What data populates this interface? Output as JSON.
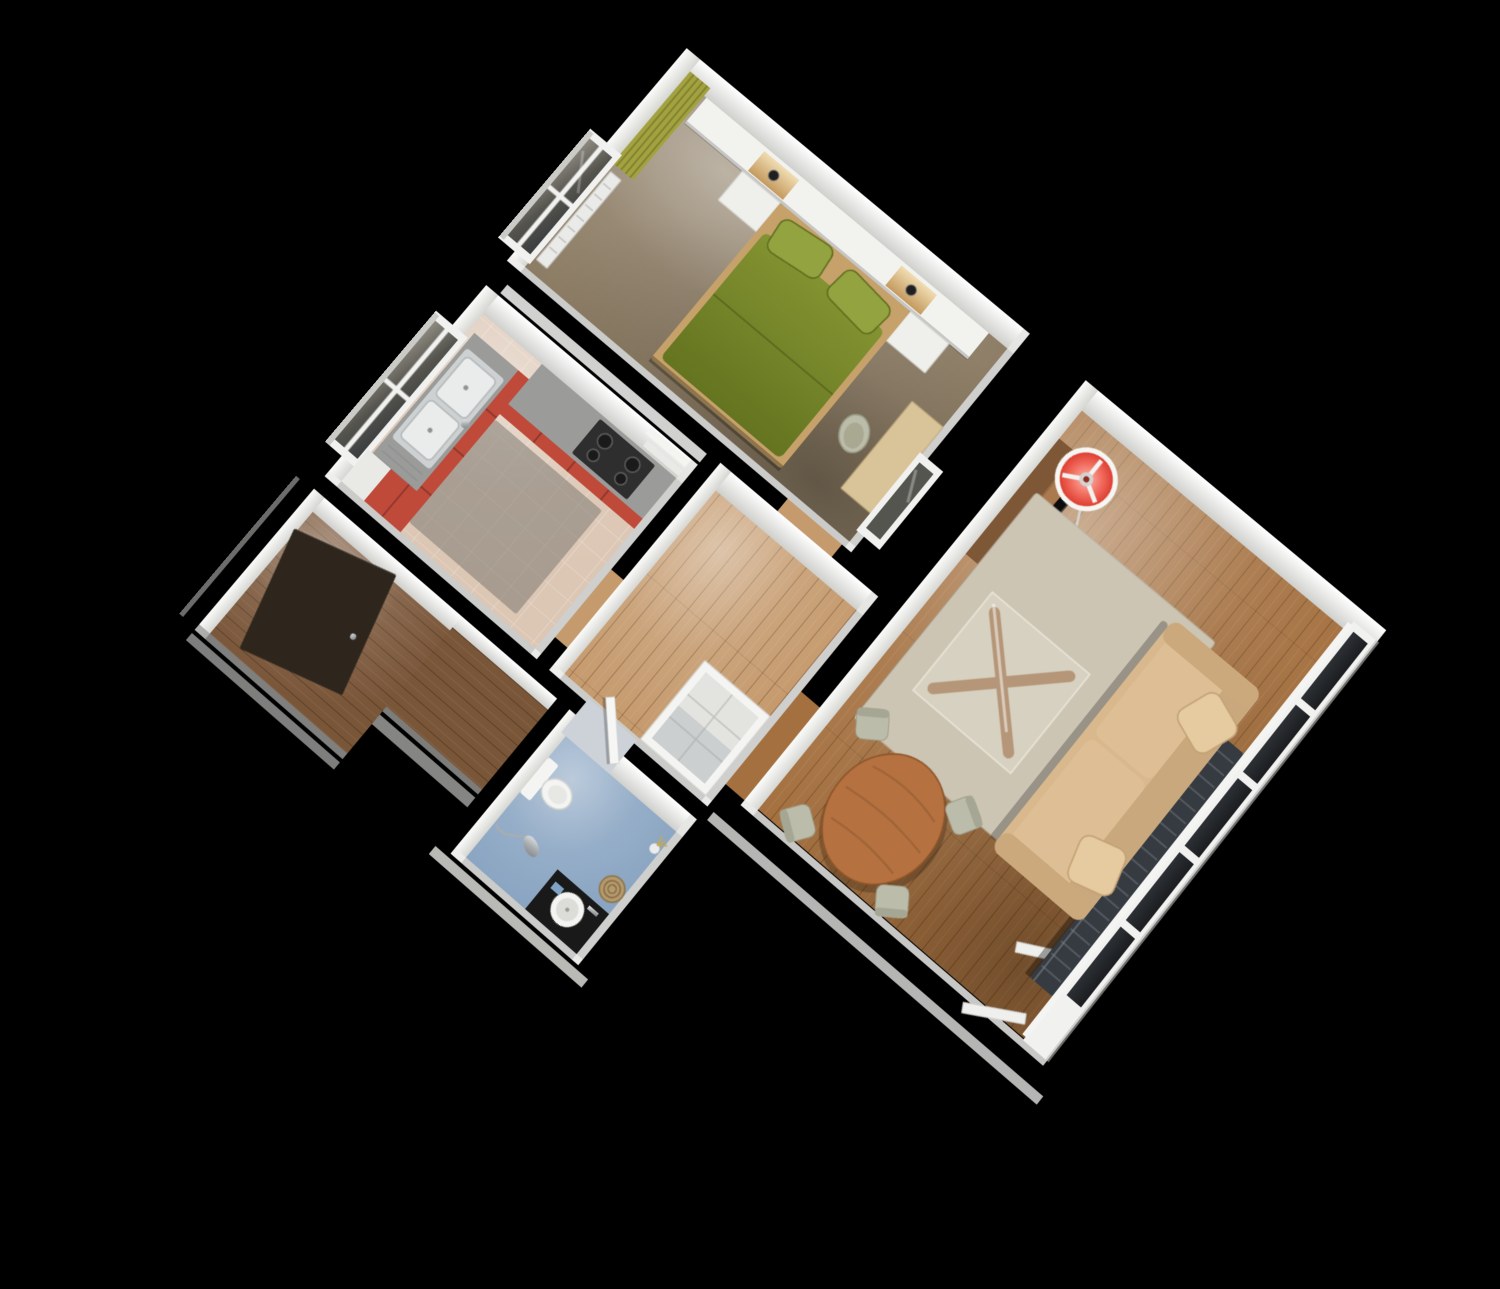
{
  "scene": {
    "kind": "3d-cutaway-floorplan-render",
    "background": "#000000",
    "rooms": [
      "bedroom",
      "kitchen",
      "hallway",
      "bathroom",
      "entry",
      "living-room"
    ]
  },
  "colors": {
    "background": "#000000",
    "wall_face_bright": "#ffffff",
    "wall_face": "#e9e9e6",
    "wall_face_dim": "#d2d2cf",
    "bedroom_carpet": "#8c7c64",
    "bed_green": "#74832a",
    "pillow_green": "#93a340",
    "bed_frame": "#c6a26a",
    "curtain_olive": "#a2a240",
    "headboard_white": "#f2f2ef",
    "radiator_white": "#eaeae8",
    "niche_glow": "#eed9a8",
    "kitchen_red": "#bf4a3a",
    "counter_gray": "#9b9c9a",
    "stove_dark": "#2e2e2e",
    "kitchen_floor": "#dcc6b4",
    "kitchen_mat": "#7d7a73",
    "sink_steel": "#cdd1d2",
    "hall_wood": "#c59a6d",
    "wardrobe_white": "#f4f4f2",
    "wardrobe_inside": "#e3e3e0",
    "entry_wood": "#7a5639",
    "entry_door": "#2e261d",
    "bath_floor": "#8aa5c2",
    "bath_counter": "#191919",
    "ceramic_white": "#f4f4f2",
    "chrome": "#b9bec2",
    "basket_tan": "#b49a6d",
    "box_blue": "#7fa3c5",
    "living_wood": "#a4703f",
    "rug_beige": "#ccc5b4",
    "table_wood": "#8e5a31",
    "sofa_beige": "#d8b88c",
    "sofa_cushion": "#debf95",
    "sofa_back": "#c8a87c",
    "sofa_pillow": "#e6cba0",
    "tv_black": "#0c0c0c",
    "tv_stand_wood": "#9a6b42",
    "lamp_red": "#e8473b",
    "lamp_base_white": "#e9e9e6",
    "curtain_dark": "#363b42",
    "curtain_rib": "#6d737b",
    "chair_sage": "#bcbcaa",
    "dining_wood": "#b5713f",
    "window_frame": "#f1f1ef",
    "threshold": "#ccd2d8",
    "door_white": "#f6f6f4"
  }
}
